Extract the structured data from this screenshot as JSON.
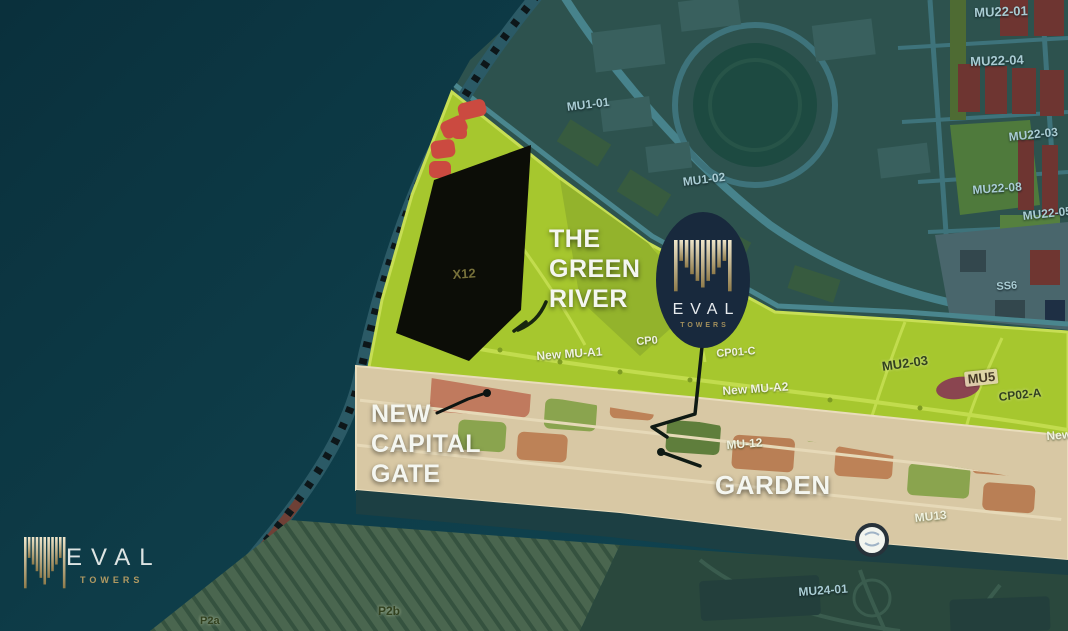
{
  "brand": {
    "name": "EVAL",
    "sub": "TOWERS"
  },
  "colors": {
    "background_teal": "#0e3d49",
    "city_slate": "#2d524e",
    "green_river": "#a6c72e",
    "green_edge": "#c7de55",
    "plot_black": "#0c0d07",
    "red_blob": "#cb4a40",
    "beige_strip": "#d8c8a4",
    "oval_navy": "#18293d",
    "logo_gold": "#c9b687"
  },
  "map": {
    "callouts": {
      "green_river": [
        "THE",
        "GREEN",
        "RIVER"
      ],
      "capital_gate": [
        "NEW",
        "CAPITAL",
        "GATE"
      ],
      "garden": "GARDEN"
    },
    "plot_labels": [
      {
        "text": "MU22-01",
        "x": 974,
        "y": 5,
        "fs": 13,
        "rot": -2,
        "style": "embossed"
      },
      {
        "text": "MU22-04",
        "x": 970,
        "y": 54,
        "fs": 13,
        "rot": -2,
        "style": "embossed"
      },
      {
        "text": "MU22-03",
        "x": 1008,
        "y": 130,
        "fs": 12,
        "rot": -6,
        "style": "embossed"
      },
      {
        "text": "MU22-08",
        "x": 972,
        "y": 183,
        "fs": 12,
        "rot": -4,
        "style": "embossed"
      },
      {
        "text": "MU22-05",
        "x": 1022,
        "y": 209,
        "fs": 12,
        "rot": -6,
        "style": "embossed"
      },
      {
        "text": "SS6",
        "x": 996,
        "y": 281,
        "fs": 11,
        "rot": -4,
        "style": "embossed"
      },
      {
        "text": "MU1-01",
        "x": 566,
        "y": 100,
        "fs": 12,
        "rot": -7,
        "style": "embossed"
      },
      {
        "text": "MU1-02",
        "x": 682,
        "y": 175,
        "fs": 12,
        "rot": -7,
        "style": "embossed"
      },
      {
        "text": "X12",
        "x": 452,
        "y": 267,
        "fs": 13,
        "rot": -4,
        "style": "gold"
      },
      {
        "text": "New MU-A1",
        "x": 536,
        "y": 349,
        "fs": 12,
        "rot": -4,
        "style": "light"
      },
      {
        "text": "CP0",
        "x": 636,
        "y": 336,
        "fs": 11,
        "rot": -4,
        "style": "light"
      },
      {
        "text": "CP01-C",
        "x": 716,
        "y": 348,
        "fs": 11,
        "rot": -4,
        "style": "light"
      },
      {
        "text": "New MU-A2",
        "x": 722,
        "y": 384,
        "fs": 12,
        "rot": -4,
        "style": "light"
      },
      {
        "text": "MU2-03",
        "x": 881,
        "y": 359,
        "fs": 13,
        "rot": -8,
        "style": "dark"
      },
      {
        "text": "MU5",
        "x": 964,
        "y": 372,
        "fs": 13,
        "rot": -6,
        "style": "badge"
      },
      {
        "text": "CP02-A",
        "x": 998,
        "y": 390,
        "fs": 12,
        "rot": -6,
        "style": "dark"
      },
      {
        "text": "New",
        "x": 1046,
        "y": 429,
        "fs": 12,
        "rot": -4,
        "style": "light"
      },
      {
        "text": "MU-12",
        "x": 726,
        "y": 438,
        "fs": 12,
        "rot": -4,
        "style": "light"
      },
      {
        "text": "MU13",
        "x": 914,
        "y": 511,
        "fs": 12,
        "rot": -6,
        "style": "light"
      },
      {
        "text": "MU24-01",
        "x": 798,
        "y": 585,
        "fs": 12,
        "rot": -4,
        "style": "embossed"
      },
      {
        "text": "P2b",
        "x": 378,
        "y": 604,
        "fs": 12,
        "rot": 0,
        "style": "dark"
      },
      {
        "text": "P2a",
        "x": 200,
        "y": 615,
        "fs": 11,
        "rot": 0,
        "style": "dark"
      }
    ]
  }
}
